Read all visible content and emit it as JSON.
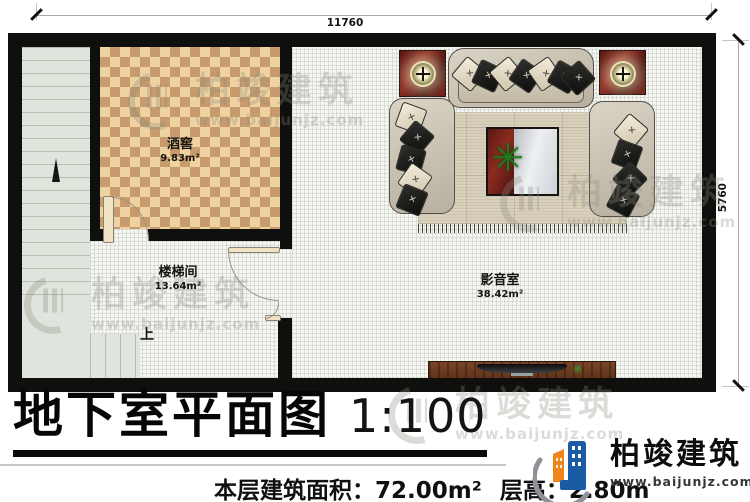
{
  "dimension_labels": {
    "top": "11760",
    "right": "5760"
  },
  "rooms": {
    "wine_cellar": {
      "name": "酒窖",
      "area": "9.83m²"
    },
    "stairwell": {
      "name": "楼梯间",
      "area": "13.64m²"
    },
    "media_room": {
      "name": "影音室",
      "area": "38.42m²"
    }
  },
  "stairs": {
    "direction_label": "上"
  },
  "title_block": {
    "title": "地下室平面图",
    "scale": "1:100",
    "floor_area": "本层建筑面积：72.00m²",
    "floor_height": "层高：2.80m"
  },
  "brand": {
    "name": "柏竣建筑",
    "website": "www.baijunjz.com"
  },
  "watermark": {
    "name": "柏竣建筑",
    "website": "www.baijunjz.com"
  },
  "icons": {
    "plant": "✳",
    "small_plant": "❋"
  },
  "colors": {
    "wall": "#0f0f0d",
    "cellar_floor_light": "#eed2a0",
    "cellar_floor_dark": "#c79b6d",
    "stairs_floor": "#dfe5dc",
    "rug_maroon": "#6b1f18",
    "sofa_beige": "#cdc5b3",
    "cabinet_wood": "#6a3b20",
    "brand_blue": "#1b5aa5",
    "brand_orange": "#f08519"
  }
}
